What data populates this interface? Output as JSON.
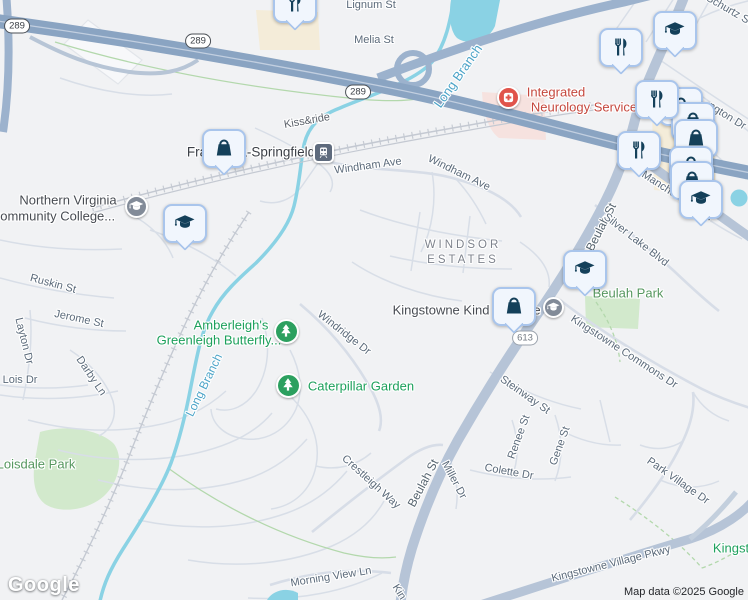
{
  "map": {
    "logo_text": "Google",
    "attribution": "Map data ©2025 Google",
    "colors": {
      "land": "#f1f2f4",
      "freeway": "#8aa4c2",
      "main_road": "#b6c4d7",
      "minor_road": "#d8dee7",
      "water": "#8ad2e4",
      "park": "#d2e9cc",
      "commercial": "#f4ecd9",
      "hospital_area": "#f6e2df",
      "marker_glyph": "#14405a",
      "marker_border": "#a9c5ec",
      "poi_green": "#1da05c",
      "park_label": "#56975f",
      "street_label": "#5b6a7a",
      "water_label": "#4da4c8",
      "medical_label": "#c5483e"
    }
  },
  "shields": [
    {
      "text": "289",
      "x": 17,
      "y": 26
    },
    {
      "text": "289",
      "x": 198,
      "y": 41
    },
    {
      "text": "289",
      "x": 358,
      "y": 92
    },
    {
      "text": "613",
      "x": 525,
      "y": 338,
      "variant": "sec"
    }
  ],
  "labels": [
    {
      "text": "Lignum St",
      "x": 371,
      "y": 5,
      "rot": 0,
      "type": "street"
    },
    {
      "text": "Melia St",
      "x": 374,
      "y": 40,
      "rot": 0,
      "type": "street"
    },
    {
      "text": "Schurtz St",
      "x": 729,
      "y": 10,
      "rot": 30,
      "type": "street"
    },
    {
      "text": "Kiss&ride",
      "x": 307,
      "y": 121,
      "rot": -10,
      "type": "place"
    },
    {
      "text": "Windham Ave",
      "x": 368,
      "y": 166,
      "rot": -8,
      "type": "street"
    },
    {
      "text": "Windham Ave",
      "x": 459,
      "y": 173,
      "rot": 26,
      "type": "street"
    },
    {
      "text": "ngton Dr",
      "x": 727,
      "y": 116,
      "rot": 32,
      "type": "street"
    },
    {
      "text": "Manchester Blvd",
      "x": 677,
      "y": 196,
      "rot": 33,
      "type": "street"
    },
    {
      "text": "Beulah St",
      "x": 601,
      "y": 227,
      "rot": -63,
      "type": "street-lg"
    },
    {
      "text": "Silver Lake Blvd",
      "x": 636,
      "y": 240,
      "rot": 38,
      "type": "street"
    },
    {
      "text": "Kingstowne Commons Dr",
      "x": 624,
      "y": 352,
      "rot": 33,
      "type": "street"
    },
    {
      "text": "Windridge Dr",
      "x": 344,
      "y": 333,
      "rot": 38,
      "type": "street"
    },
    {
      "text": "Ruskin St",
      "x": 53,
      "y": 284,
      "rot": 15,
      "type": "street"
    },
    {
      "text": "Jerome St",
      "x": 79,
      "y": 319,
      "rot": 12,
      "type": "street"
    },
    {
      "text": "Layton Dr",
      "x": 24,
      "y": 341,
      "rot": 76,
      "type": "street"
    },
    {
      "text": "Lois Dr",
      "x": 20,
      "y": 380,
      "rot": 0,
      "type": "street"
    },
    {
      "text": "Darby Ln",
      "x": 91,
      "y": 376,
      "rot": 56,
      "type": "street"
    },
    {
      "text": "Steinway St",
      "x": 525,
      "y": 395,
      "rot": 35,
      "type": "street"
    },
    {
      "text": "Renee St",
      "x": 519,
      "y": 437,
      "rot": -70,
      "type": "street"
    },
    {
      "text": "Gene St",
      "x": 560,
      "y": 446,
      "rot": -70,
      "type": "street"
    },
    {
      "text": "Colette Dr",
      "x": 509,
      "y": 472,
      "rot": 10,
      "type": "street"
    },
    {
      "text": "Miller Dr",
      "x": 454,
      "y": 480,
      "rot": 62,
      "type": "street"
    },
    {
      "text": "Beulah St",
      "x": 423,
      "y": 483,
      "rot": -62,
      "type": "street-lg"
    },
    {
      "text": "Crestleigh Way",
      "x": 371,
      "y": 482,
      "rot": 42,
      "type": "street"
    },
    {
      "text": "Morning View Ln",
      "x": 331,
      "y": 577,
      "rot": -9,
      "type": "street"
    },
    {
      "text": "Kin",
      "x": 399,
      "y": 592,
      "rot": 58,
      "type": "street"
    },
    {
      "text": "Park Village Dr",
      "x": 678,
      "y": 481,
      "rot": 35,
      "type": "street"
    },
    {
      "text": "Kingstowne Village Pkwy",
      "x": 611,
      "y": 564,
      "rot": -14,
      "type": "street"
    },
    {
      "text": "Long Branch",
      "x": 458,
      "y": 76,
      "rot": -55,
      "type": "water",
      "size": 13
    },
    {
      "text": "Long Branch",
      "x": 204,
      "y": 385,
      "rot": -64,
      "type": "water"
    },
    {
      "text": "WINDSOR",
      "x": 463,
      "y": 245,
      "rot": 0,
      "type": "area"
    },
    {
      "text": "ESTATES",
      "x": 463,
      "y": 260,
      "rot": 0,
      "type": "area"
    },
    {
      "text": "Northern Virginia",
      "x": 68,
      "y": 200,
      "rot": 0,
      "type": "poi"
    },
    {
      "text": "Community College...",
      "x": 53,
      "y": 216,
      "rot": 0,
      "type": "poi"
    },
    {
      "text": "Kingstowne Kind",
      "x": 441,
      "y": 310,
      "rot": 0,
      "type": "poi"
    },
    {
      "text": "e",
      "x": 537,
      "y": 310,
      "rot": 0,
      "type": "poi"
    },
    {
      "text": "Franconia-Springfield",
      "x": 251,
      "y": 152,
      "rot": 0,
      "type": "transit"
    },
    {
      "text": "Beulah Park",
      "x": 628,
      "y": 293,
      "rot": 0,
      "type": "park"
    },
    {
      "text": "Loisdale Park",
      "x": 36,
      "y": 464,
      "rot": 0,
      "type": "park"
    },
    {
      "text": "Amberleigh's",
      "x": 231,
      "y": 325,
      "rot": 0,
      "type": "poi-green"
    },
    {
      "text": "Greenleigh Butterfly...",
      "x": 219,
      "y": 340,
      "rot": 0,
      "type": "poi-green"
    },
    {
      "text": "Caterpillar Garden",
      "x": 361,
      "y": 386,
      "rot": 0,
      "type": "poi-green"
    },
    {
      "text": "Kingst",
      "x": 731,
      "y": 548,
      "rot": 0,
      "type": "poi-green"
    },
    {
      "text": "Integrated",
      "x": 556,
      "y": 92,
      "rot": 0,
      "type": "medical"
    },
    {
      "text": "Neurology Service",
      "x": 584,
      "y": 107,
      "rot": 0,
      "type": "medical"
    }
  ],
  "markers": {
    "plaques": [
      {
        "icon": "bag",
        "x": 679,
        "y": 104
      },
      {
        "icon": "bag",
        "x": 691,
        "y": 119
      },
      {
        "icon": "restaurant",
        "x": 655,
        "y": 97
      },
      {
        "icon": "bag",
        "x": 694,
        "y": 136
      },
      {
        "icon": "bag",
        "x": 689,
        "y": 163
      },
      {
        "icon": "bag",
        "x": 690,
        "y": 178
      },
      {
        "icon": "restaurant",
        "x": 637,
        "y": 148
      },
      {
        "icon": "education",
        "x": 699,
        "y": 197
      },
      {
        "icon": "restaurant",
        "x": 293,
        "y": 1
      },
      {
        "icon": "education",
        "x": 673,
        "y": 28
      },
      {
        "icon": "restaurant",
        "x": 619,
        "y": 45
      },
      {
        "icon": "bag",
        "x": 222,
        "y": 146
      },
      {
        "icon": "education",
        "x": 183,
        "y": 221
      },
      {
        "icon": "education",
        "x": 583,
        "y": 267
      },
      {
        "icon": "bag",
        "x": 512,
        "y": 304
      }
    ],
    "circles": [
      {
        "icon": "education-dot",
        "x": 136,
        "y": 206,
        "d": 23
      },
      {
        "icon": "education-dot",
        "x": 553,
        "y": 307,
        "d": 21
      },
      {
        "icon": "tree",
        "x": 286,
        "y": 331,
        "d": 25
      },
      {
        "icon": "tree",
        "x": 288,
        "y": 385,
        "d": 25
      },
      {
        "icon": "station",
        "x": 323,
        "y": 152,
        "d": 21
      },
      {
        "icon": "hospital",
        "x": 508,
        "y": 97,
        "d": 23
      }
    ]
  }
}
